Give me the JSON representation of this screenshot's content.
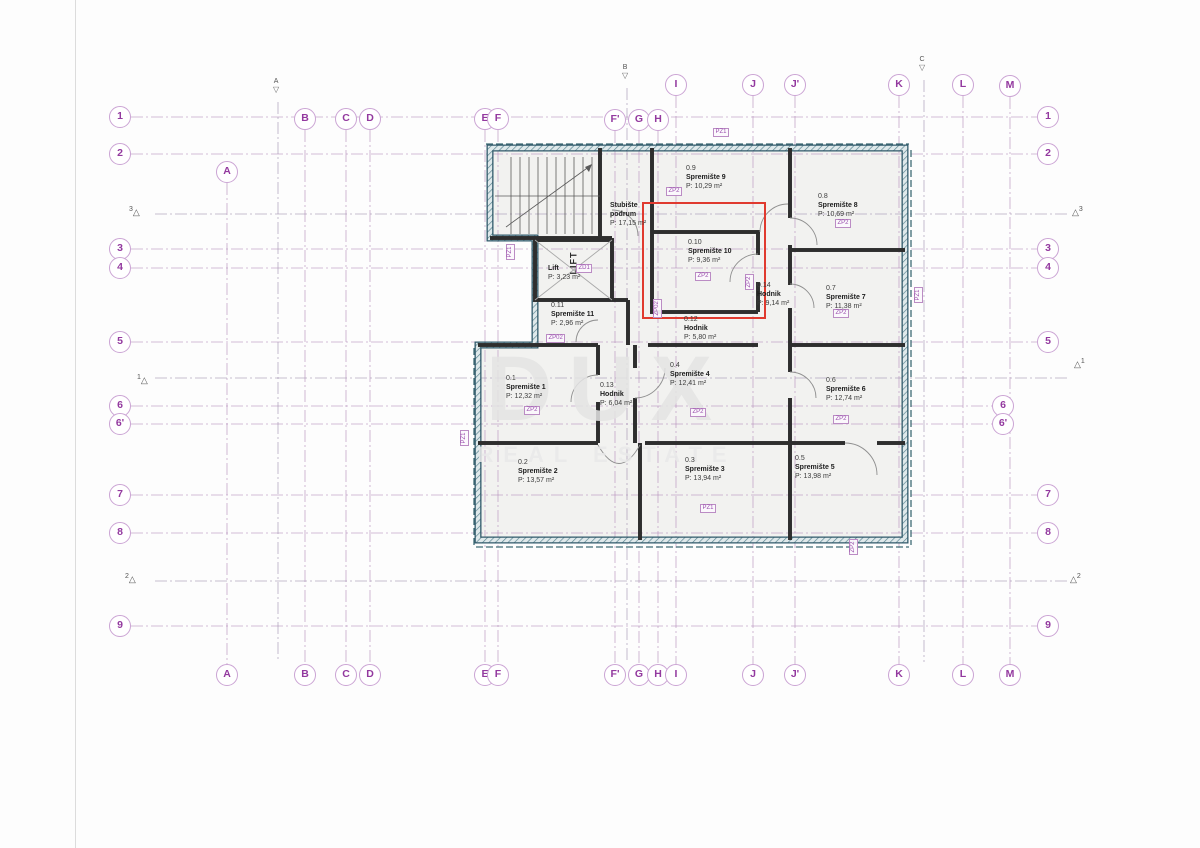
{
  "watermark": {
    "line1": "DUX",
    "line2": "REAL ESTATE"
  },
  "symbols": {
    "marker_triangle_up": "△",
    "marker_triangle_down": "▽"
  },
  "grid": {
    "column_labels": [
      "A",
      "B",
      "C",
      "D",
      "E",
      "F",
      "F'",
      "G",
      "H",
      "I",
      "J",
      "J'",
      "K",
      "L",
      "M"
    ],
    "row_labels": [
      "1",
      "2",
      "3",
      "4",
      "5",
      "6",
      "6'",
      "7",
      "8",
      "9"
    ],
    "section_top_labels": [
      "A",
      "B",
      "C"
    ],
    "section_side_labels": [
      "3",
      "1",
      "2"
    ]
  },
  "rooms": [
    {
      "id": "0.1",
      "name": "Spremište 1",
      "area": "P: 12,32 m²",
      "tag": "ZP2"
    },
    {
      "id": "0.2",
      "name": "Spremište 2",
      "area": "P: 13,57 m²"
    },
    {
      "id": "0.3",
      "name": "Spremište 3",
      "area": "P: 13,94 m²"
    },
    {
      "id": "0.4",
      "name": "Spremište 4",
      "area": "P: 12,41 m²",
      "tag": "ZP2"
    },
    {
      "id": "0.5",
      "name": "Spremište 5",
      "area": "P: 13,98 m²"
    },
    {
      "id": "0.6",
      "name": "Spremište 6",
      "area": "P: 12,74 m²",
      "tag": "ZP2"
    },
    {
      "id": "0.7",
      "name": "Spremište 7",
      "area": "P: 11,38 m²",
      "tag": "ZP2"
    },
    {
      "id": "0.8",
      "name": "Spremište 8",
      "area": "P: 10,69 m²",
      "tag": "ZP2"
    },
    {
      "id": "0.9",
      "name": "Spremište 9",
      "area": "P: 10,29 m²",
      "tag": "ZP2"
    },
    {
      "id": "0.10",
      "name": "Spremište 10",
      "area": "P: 9,36 m²",
      "tag": "ZP2",
      "highlight": true
    },
    {
      "id": "0.11",
      "name": "Spremište 11",
      "area": "P: 2,96 m²"
    },
    {
      "id": "0.12",
      "name": "Hodnik",
      "area": "P: 5,80 m²"
    },
    {
      "id": "0.13",
      "name": "Hodnik",
      "area": "P: 6,04 m²"
    },
    {
      "id": "0.14",
      "name": "Hodnik",
      "area": "P: 9,14 m²"
    },
    {
      "id": "",
      "name": "Stubište",
      "name2": "podrum",
      "area": "P: 17,15 m²"
    },
    {
      "id": "",
      "name": "Lift",
      "area": "P: 3,23 m²"
    }
  ],
  "extra_tags": [
    "PZ1",
    "PZ1",
    "PZ1",
    "PZ1",
    "PZ1",
    "ZP02",
    "ZP02",
    "ZD1",
    "ZP2",
    "ZP2"
  ],
  "lift_shaft_label": "LIFT",
  "colors": {
    "grid_line": "#b48cba",
    "bubble_text": "#93399f",
    "wall_teal": "#30596a",
    "highlight_red": "#e03a2f",
    "watermark_gray": "#e4e4e4"
  }
}
